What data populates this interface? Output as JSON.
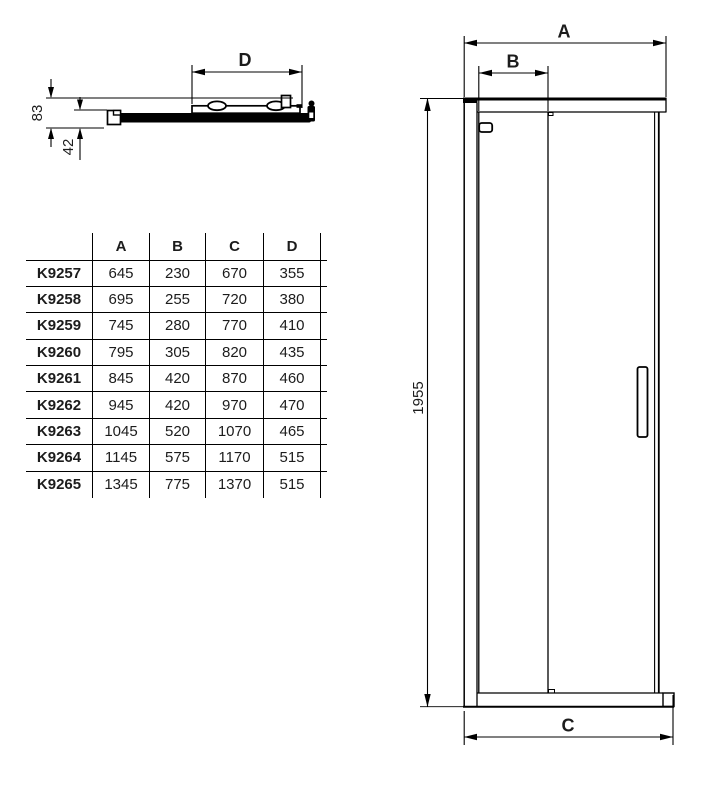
{
  "top_view": {
    "dim_d_label": "D",
    "dim_83_label": "83",
    "dim_42_label": "42"
  },
  "front_view": {
    "dim_a_label": "A",
    "dim_b_label": "B",
    "dim_c_label": "C",
    "dim_height_label": "1955"
  },
  "table": {
    "headers": [
      "A",
      "B",
      "C",
      "D"
    ],
    "rows": [
      {
        "model": "K9257",
        "values": [
          "645",
          "230",
          "670",
          "355"
        ]
      },
      {
        "model": "K9258",
        "values": [
          "695",
          "255",
          "720",
          "380"
        ]
      },
      {
        "model": "K9259",
        "values": [
          "745",
          "280",
          "770",
          "410"
        ]
      },
      {
        "model": "K9260",
        "values": [
          "795",
          "305",
          "820",
          "435"
        ]
      },
      {
        "model": "K9261",
        "values": [
          "845",
          "420",
          "870",
          "460"
        ]
      },
      {
        "model": "K9262",
        "values": [
          "945",
          "420",
          "970",
          "470"
        ]
      },
      {
        "model": "K9263",
        "values": [
          "1045",
          "520",
          "1070",
          "465"
        ]
      },
      {
        "model": "K9264",
        "values": [
          "1145",
          "575",
          "1170",
          "515"
        ]
      },
      {
        "model": "K9265",
        "values": [
          "1345",
          "775",
          "1370",
          "515"
        ]
      }
    ]
  },
  "colors": {
    "line": "#000000",
    "text": "#1c1c1c",
    "background": "#ffffff"
  }
}
